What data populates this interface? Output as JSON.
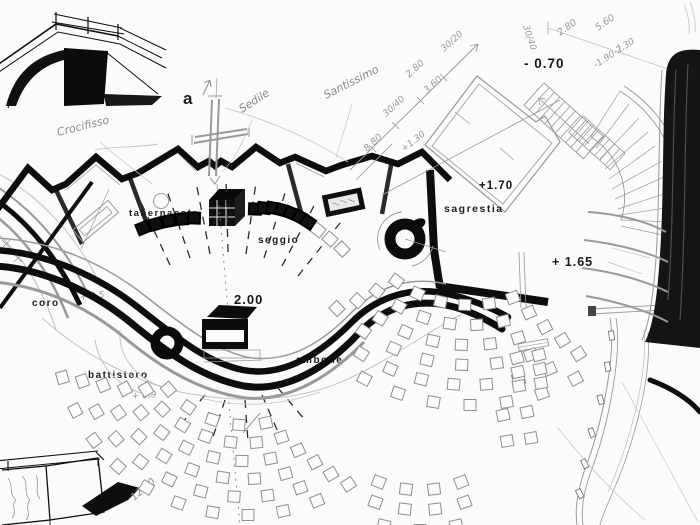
{
  "drawing_type": "hand-drawn church plan sketch",
  "labels": {
    "section_letter": "a",
    "tabernacolo": "tabernacolo",
    "seggio": "seggio",
    "sagrestia": "sagrestia",
    "coro": "coro",
    "battistero": "battistero",
    "ambone": "ambone"
  },
  "levels": {
    "altar": "2.00",
    "sacristy": "+1.70",
    "entry": "- 0.70",
    "side": "+ 1.65"
  },
  "handwritten": {
    "crocifisso": "Crocifisso",
    "sedile": "Sedile",
    "santissimo": "Santissimo",
    "plus130": "+1.30",
    "coro_level": "+ 0,5",
    "batt_level": "+ 0,9",
    "dim1250": "12.50",
    "dim880": "8.80",
    "dim3040a": "30/40",
    "dim280a": "2.80",
    "dim360": "3.60",
    "dim3020": "30/20",
    "dim280b": "2.80",
    "dim560": "5.60",
    "dim3040b": "30/40",
    "dimrange": "-1.90-2.30"
  },
  "colors": {
    "ink": "#0d0d0d",
    "pencil": "#999999",
    "paper": "#fbfbf9"
  },
  "seating": {
    "banks": [
      {
        "kind": "pew",
        "cx": 245,
        "cy": 325,
        "rows": [
          [
            100,
            78,
            140,
            5
          ],
          [
            118,
            72,
            147,
            7
          ],
          [
            136,
            67,
            152,
            8
          ],
          [
            154,
            63,
            157,
            9
          ],
          [
            172,
            60,
            161,
            10
          ],
          [
            190,
            57,
            164,
            11
          ]
        ]
      },
      {
        "kind": "pew",
        "cx": 470,
        "cy": 180,
        "rows": [
          [
            125,
            70,
            126,
            6
          ],
          [
            145,
            66,
            130,
            7
          ],
          [
            165,
            63,
            133,
            8
          ],
          [
            185,
            60,
            136,
            8
          ],
          [
            205,
            58,
            122,
            8
          ],
          [
            225,
            62,
            118,
            7
          ]
        ]
      },
      {
        "kind": "pew",
        "cx": 420,
        "cy": 380,
        "rows": [
          [
            110,
            68,
            112,
            4
          ],
          [
            130,
            70,
            110,
            4
          ],
          [
            150,
            76,
            104,
            3
          ]
        ]
      },
      {
        "kind": "pew",
        "seats": [
          [
            517,
            358,
            -15
          ],
          [
            539,
            355,
            -15
          ],
          [
            518,
            372,
            -13
          ],
          [
            540,
            369,
            -13
          ],
          [
            519,
            386,
            -10
          ],
          [
            541,
            383,
            -10
          ],
          [
            503,
            415,
            -12
          ],
          [
            527,
            412,
            -12
          ],
          [
            507,
            441,
            -10
          ],
          [
            531,
            438,
            -10
          ],
          [
            318,
            230,
            38
          ],
          [
            330,
            239,
            42
          ],
          [
            342,
            249,
            45
          ]
        ]
      },
      {
        "kind": "chair-dark",
        "seats": [
          [
            143,
            228,
            -22
          ],
          [
            156,
            224,
            -16
          ],
          [
            169,
            221,
            -10
          ],
          [
            182,
            219,
            -4
          ],
          [
            194,
            218,
            2
          ],
          [
            255,
            209,
            2
          ],
          [
            264,
            208,
            6
          ],
          [
            273,
            208,
            10
          ],
          [
            282,
            210,
            16
          ],
          [
            291,
            213,
            22
          ],
          [
            300,
            217,
            28
          ],
          [
            308,
            222,
            33
          ]
        ]
      }
    ]
  }
}
